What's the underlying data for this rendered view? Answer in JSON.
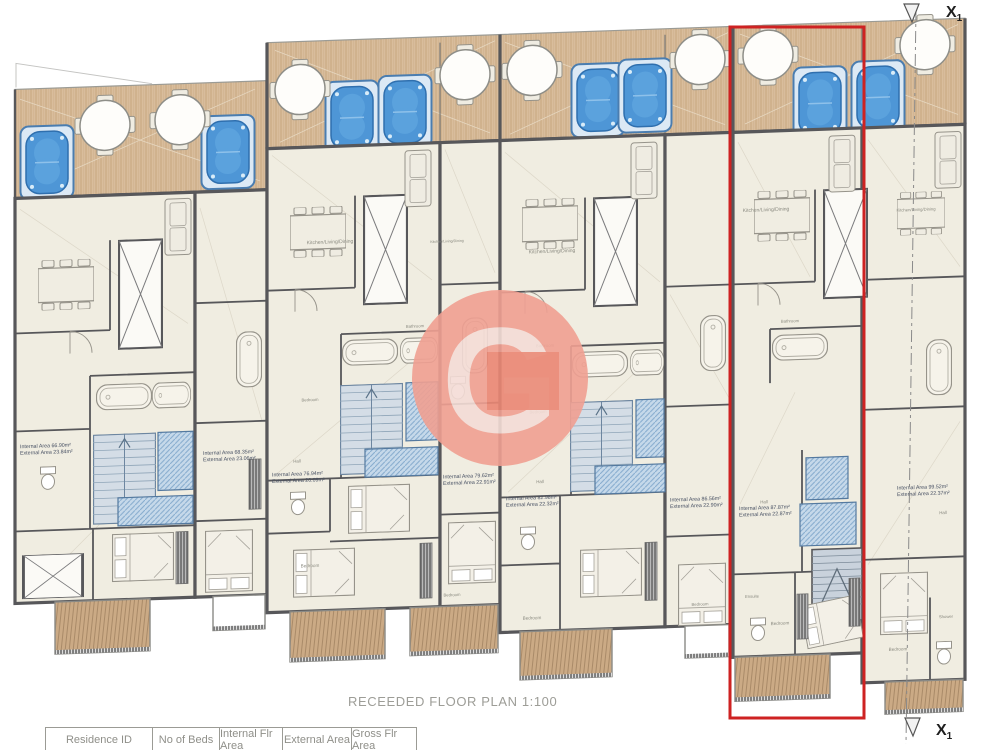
{
  "title": "RECEEDED FLOOR PLAN 1:100",
  "watermark_letter": "G",
  "section_marker": {
    "main": "X",
    "sub": "1"
  },
  "table": {
    "headers": [
      "Residence ID",
      "No of Beds",
      "Internal Flr Area",
      "External Area",
      "Gross Flr Area"
    ]
  },
  "colors": {
    "highlight_red": "#ce2222",
    "watermark_salmon": "#f0a092",
    "deck_tan": "#d9bd9c",
    "pool_blue": "#4e96d6",
    "wall_gray": "#57575a",
    "floor_cream": "#f0ede1"
  },
  "plan": {
    "annotations": [
      {
        "x": 20,
        "y": 449,
        "internal": "Internal Area 66.90m²",
        "external": "External Area 23.84m²"
      },
      {
        "x": 203,
        "y": 462,
        "internal": "Internal Area 68.35m²",
        "external": "External Area 23.06m²"
      },
      {
        "x": 272,
        "y": 486,
        "internal": "Internal Area 76.94m²",
        "external": "External Area 20.09m²"
      },
      {
        "x": 443,
        "y": 494,
        "internal": "Internal Area 79.62m²",
        "external": "External Area 22.91m²"
      },
      {
        "x": 506,
        "y": 518,
        "internal": "Internal Area 82.98m²",
        "external": "External Area 22.32m²"
      },
      {
        "x": 670,
        "y": 525,
        "internal": "Internal Area 86.56m²",
        "external": "External Area 22.90m²"
      },
      {
        "x": 739,
        "y": 536,
        "internal": "Internal Area 87.87m²",
        "external": "External Area 22.87m²"
      },
      {
        "x": 897,
        "y": 521,
        "internal": "Internal Area 99.52m²",
        "external": "External Area 22.37m²"
      }
    ],
    "labels": [
      {
        "x": 330,
        "y": 255,
        "size": 5.0,
        "text": "Kitchen/Living/Dining"
      },
      {
        "x": 447,
        "y": 258,
        "size": 3.6,
        "text": "Kitchen/Living/Dining"
      },
      {
        "x": 552,
        "y": 272,
        "size": 5.0,
        "text": "Kitchen/Living/Dining"
      },
      {
        "x": 766,
        "y": 238,
        "size": 5.0,
        "text": "Kitchen/Living/Dining"
      },
      {
        "x": 916,
        "y": 243,
        "size": 4.2,
        "text": "Kitchen/Living/Dining"
      },
      {
        "x": 310,
        "y": 412,
        "size": 4.2,
        "text": "Bedroom"
      },
      {
        "x": 538,
        "y": 432,
        "size": 4.2,
        "text": "Bedroom"
      },
      {
        "x": 310,
        "y": 578,
        "size": 4.6,
        "text": "Bedroom"
      },
      {
        "x": 452,
        "y": 612,
        "size": 4.2,
        "text": "Bedroom"
      },
      {
        "x": 532,
        "y": 638,
        "size": 4.6,
        "text": "Bedroom"
      },
      {
        "x": 700,
        "y": 630,
        "size": 4.2,
        "text": "Bedroom"
      },
      {
        "x": 780,
        "y": 652,
        "size": 4.6,
        "text": "Bedroom"
      },
      {
        "x": 898,
        "y": 682,
        "size": 4.6,
        "text": "Bedroom"
      },
      {
        "x": 415,
        "y": 342,
        "size": 4.2,
        "text": "Bathroom"
      },
      {
        "x": 545,
        "y": 366,
        "size": 4.2,
        "text": "Bathroom"
      },
      {
        "x": 790,
        "y": 350,
        "size": 4.2,
        "text": "Bathroom"
      },
      {
        "x": 297,
        "y": 473,
        "size": 4.4,
        "text": "Hall"
      },
      {
        "x": 540,
        "y": 502,
        "size": 4.4,
        "text": "Hall"
      },
      {
        "x": 764,
        "y": 530,
        "size": 4.4,
        "text": "Hall"
      },
      {
        "x": 943,
        "y": 547,
        "size": 4.4,
        "text": "Hall"
      },
      {
        "x": 752,
        "y": 624,
        "size": 4.2,
        "text": "Ensuite"
      },
      {
        "x": 946,
        "y": 651,
        "size": 4.2,
        "text": "Shower"
      }
    ]
  }
}
